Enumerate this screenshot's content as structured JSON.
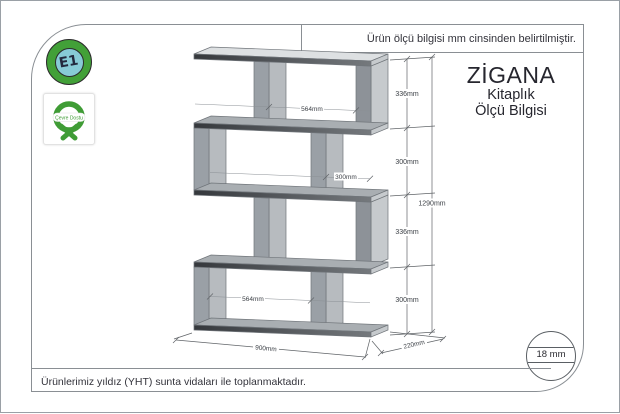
{
  "notes": {
    "top": "Ürün ölçü bilgisi mm cinsinden belirtilmiştir.",
    "bottom": "Ürünlerimiz yıldız (YHT) sunta vidaları ile toplanmaktadır."
  },
  "title": {
    "product": "ZİGANA",
    "subtitle1": "Kitaplık",
    "subtitle2": "Ölçü Bilgisi"
  },
  "badges": {
    "e1_label": "E1",
    "eco_label": "Çevre Dostu"
  },
  "material": {
    "thickness": "18 mm"
  },
  "drawing": {
    "type": "furniture-dimension-diagram",
    "subject": "zigzag bookshelf with 4 compartments",
    "dims": {
      "total_height": "1290mm",
      "total_width": "900mm",
      "depth": "220mm",
      "section_heights": [
        "336mm",
        "300mm",
        "336mm",
        "300mm"
      ],
      "comp1_inner_width": "564mm",
      "comp2_inner_width": "300mm",
      "comp4_inner_width": "564mm"
    }
  }
}
